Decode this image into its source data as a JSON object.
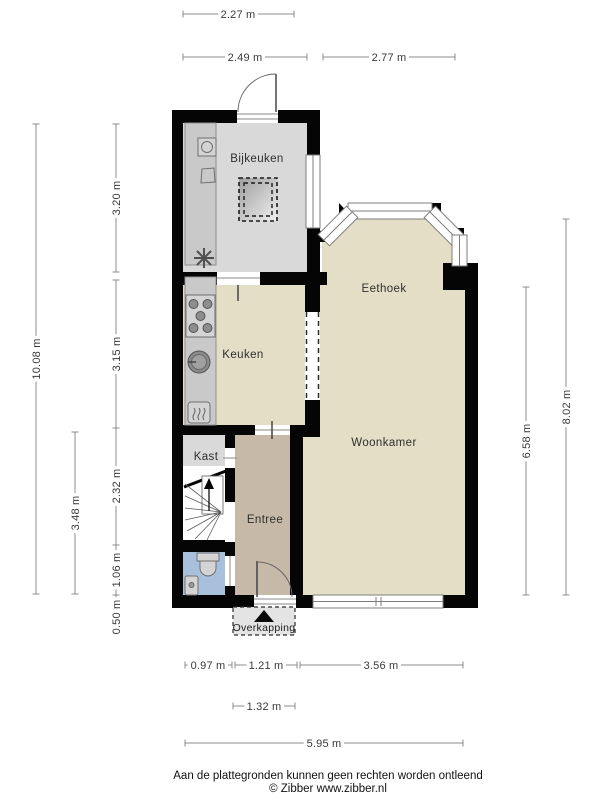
{
  "rooms": {
    "bijkeuken": "Bijkeuken",
    "eethoek": "Eethoek",
    "keuken": "Keuken",
    "woonkamer": "Woonkamer",
    "kast": "Kast",
    "entree": "Entree",
    "overkapping": "Overkapping"
  },
  "dimensions": {
    "top": [
      "2.27 m",
      "2.49 m",
      "2.77 m"
    ],
    "left": [
      "10.08 m",
      "3.20 m",
      "3.15 m",
      "3.48 m",
      "2.32 m",
      "1.06 m",
      "0.50 m"
    ],
    "right": [
      "6.58 m",
      "8.02 m"
    ],
    "bottom": [
      "0.97 m",
      "1.21 m",
      "3.56 m",
      "1.32 m",
      "5.95 m"
    ]
  },
  "footer": {
    "disclaimer": "Aan de plattegronden kunnen geen rechten worden ontleend",
    "copyright": "© Zibber www.zibber.nl"
  },
  "colors": {
    "wall": "#050505",
    "floor_main": "#e5dec7",
    "floor_utility": "#d9d9d9",
    "floor_hall": "#c7b9a8",
    "floor_closet": "#d9d9d9",
    "floor_toilet": "#a9c0dc",
    "counter": "#c9c9c9",
    "overkapping_fill": "#e4e4e4"
  }
}
